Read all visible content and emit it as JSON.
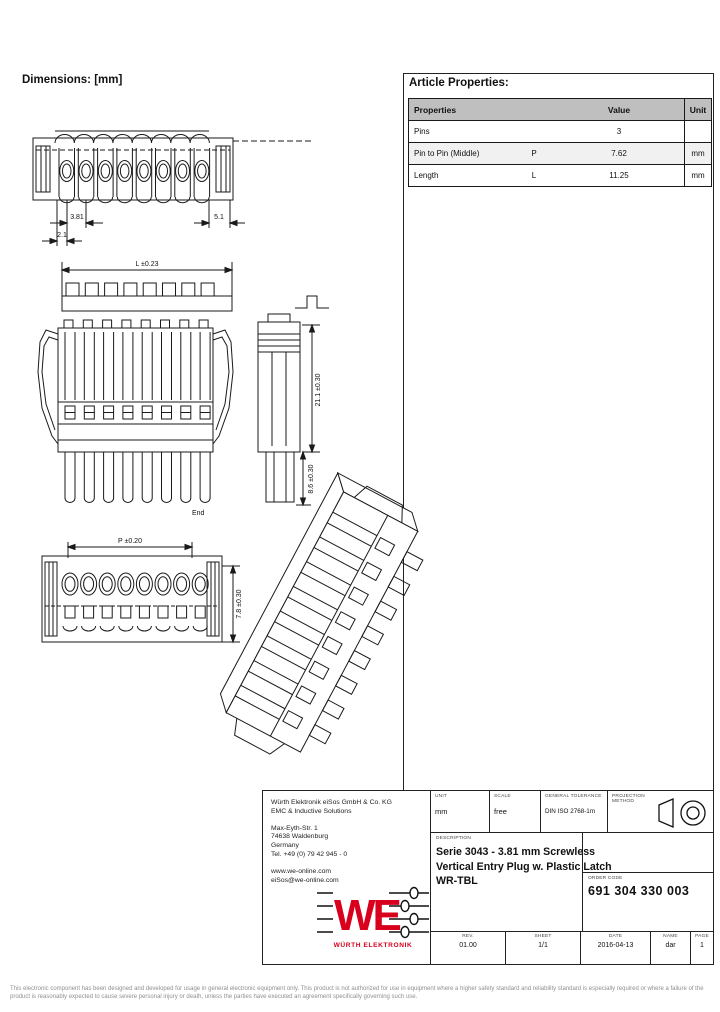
{
  "header": {
    "dimensions_label": "Dimensions: [mm]",
    "article_properties_label": "Article Properties:"
  },
  "article_table": {
    "col_properties": "Properties",
    "col_value": "Value",
    "col_unit": "Unit",
    "rows": [
      {
        "property": "Pins",
        "symbol": "",
        "value": "3",
        "unit": ""
      },
      {
        "property": "Pin to Pin (Middle)",
        "symbol": "P",
        "value": "7.62",
        "unit": "mm"
      },
      {
        "property": "Length",
        "symbol": "L",
        "value": "11.25",
        "unit": "mm"
      }
    ]
  },
  "drawing_dims": {
    "pitch": "3.81",
    "offset": "2.1",
    "end_width": "5.1",
    "length": "L ±0.23",
    "height": "21.1 ±0.30",
    "depth": "8.6 ±0.30",
    "end_label": "End",
    "pin_spacing": "P ±0.20",
    "front_height": "7.8 ±0.30"
  },
  "title_block": {
    "address_lines": [
      "Würth Elektronik eiSos GmbH & Co. KG",
      "EMC & Inductive Solutions",
      "Max-Eyth-Str. 1",
      "74638 Waldenburg",
      "Germany",
      "Tel. +49 (0) 79 42 945 - 0",
      "www.we-online.com",
      "eiSos@we-online.com"
    ],
    "logo_text": "WE",
    "logo_subtext": "WÜRTH ELEKTRONIK",
    "logo_color": "#d8001d",
    "unit_label": "UNIT",
    "unit_value": "mm",
    "scale_label": "SCALE",
    "scale_value": "free",
    "tolerance_label": "GENERAL TOLERANCE",
    "tolerance_value": "DIN ISO 2768-1m",
    "projection_label": "PROJECTION METHOD",
    "description_label": "DESCRIPTION",
    "description_line1": "Serie 3043 - 3.81 mm Screwless",
    "description_line2": "Vertical Entry Plug w. Plastic Latch",
    "description_line3": "WR-TBL",
    "order_code_label": "ORDER CODE",
    "order_code_value": "691 304 330 003",
    "footer_cells": [
      {
        "label": "REV.",
        "value": "01.00"
      },
      {
        "label": "SHEET",
        "value": "1/1"
      },
      {
        "label": "DATE",
        "value": "2016-04-13"
      },
      {
        "label": "NAME",
        "value": "dar"
      },
      {
        "label": "PAGE",
        "value": "1"
      }
    ]
  },
  "disclaimer": "This electronic component has been designed and developed for usage in general electronic equipment only. This product is not authorized for use in equipment where a higher safety standard and reliability standard is especially required or where a failure of the product is reasonably expected to cause severe personal injury or death, unless the parties have executed an agreement specifically governing such use."
}
